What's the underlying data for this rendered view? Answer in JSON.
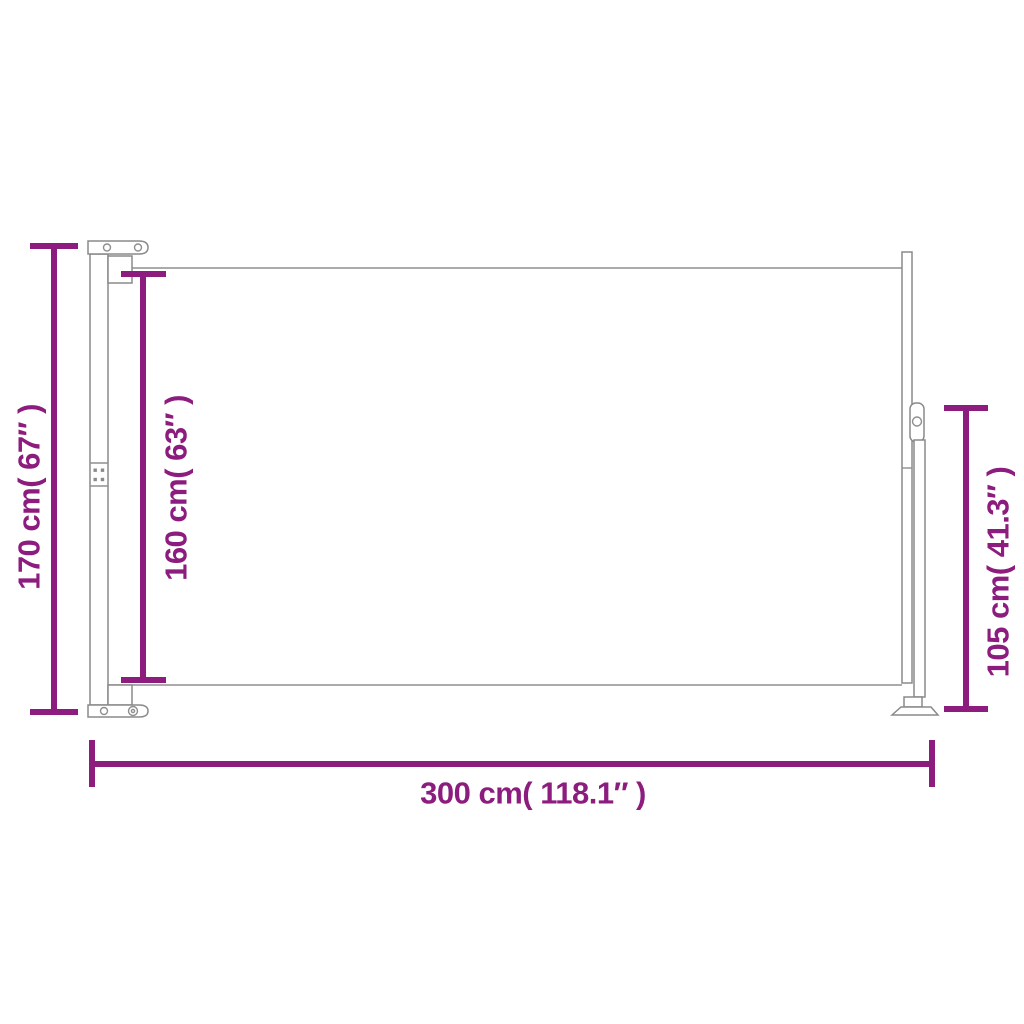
{
  "image": {
    "title": "Retractable side awning dimension diagram",
    "background": "#ffffff"
  },
  "colors": {
    "dimension_accent": "#8C1C7E",
    "outline_gray": "#8A8A8A"
  },
  "dimensions": {
    "height_total": {
      "label": "170 cm( 67″ )",
      "cm": 170,
      "inch": 67
    },
    "height_fabric": {
      "label": "160 cm( 63″ )",
      "cm": 160,
      "inch": 63
    },
    "height_leg": {
      "label": "105 cm( 41.3″ )",
      "cm": 105,
      "inch": 41.3
    },
    "width_total": {
      "label": "300 cm( 118.1″ )",
      "cm": 300,
      "inch": 118.1
    }
  }
}
